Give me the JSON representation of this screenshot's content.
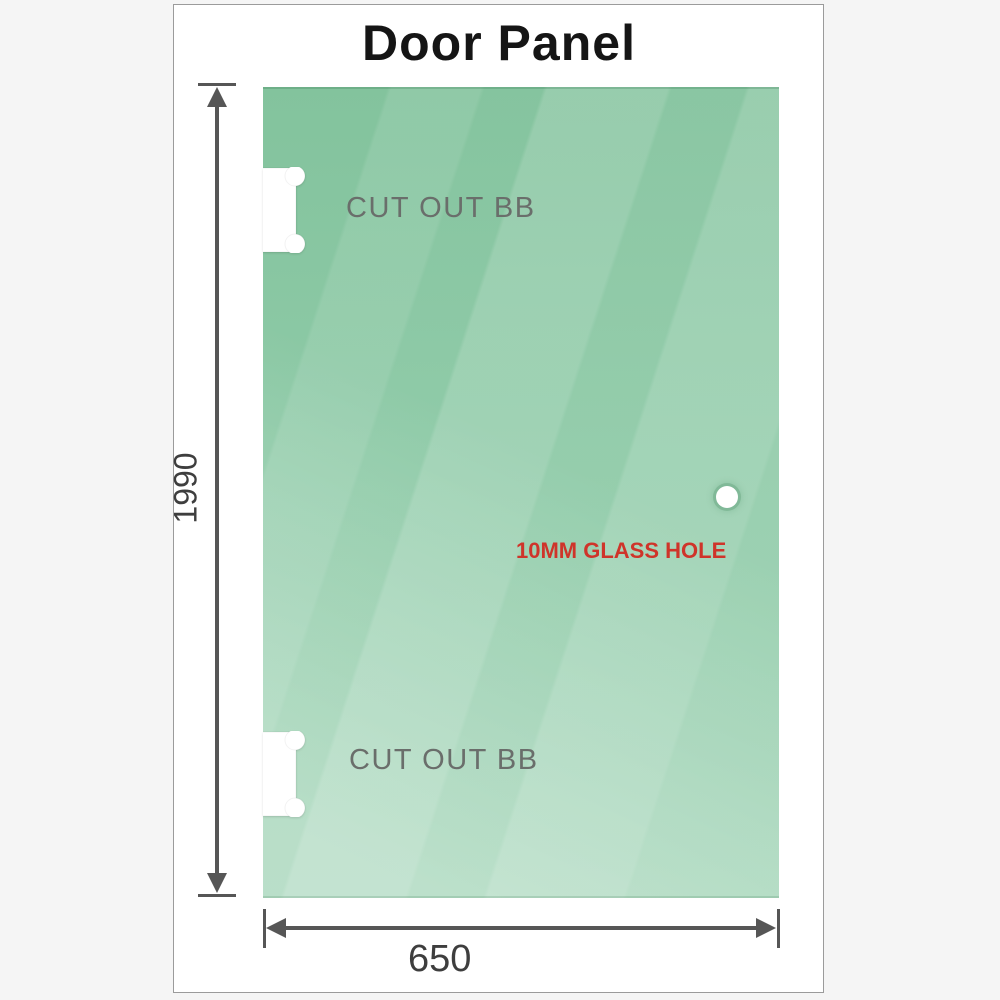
{
  "title": "Door Panel",
  "glass_panel": {
    "cutouts": [
      {
        "label": "CUT OUT BB"
      },
      {
        "label": "CUT OUT BB"
      }
    ],
    "hole": {
      "label": "10MM GLASS HOLE"
    }
  },
  "dimensions": {
    "height": "1990",
    "width": "650"
  },
  "colors": {
    "glass_green_top": "#83c39d",
    "glass_green_bottom": "#97cfae",
    "dimension_gray": "#565656",
    "hole_label_red": "#cf342a",
    "label_gray": "#6a6e6b",
    "title_black": "#151515",
    "frame_border": "#9b9b9b",
    "page_background": "#f5f5f5"
  }
}
